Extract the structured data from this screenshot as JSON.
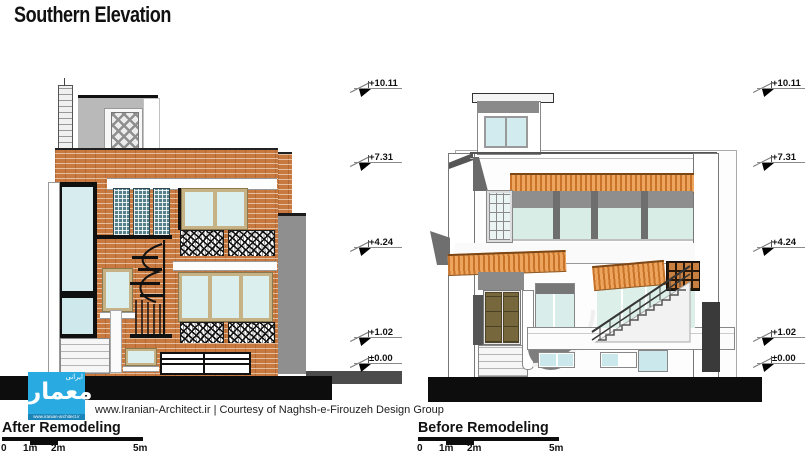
{
  "title": "Southern Elevation",
  "credit": "www.Iranian-Architect.ir | Courtesy of Naghsh-e-Firouzeh Design Group",
  "markers": {
    "values": [
      "+10.11",
      "+7.31",
      "+4.24",
      "+1.02",
      "±0.00"
    ]
  },
  "after": {
    "label": "After Remodeling",
    "ticks": [
      "0",
      "1m",
      "2m",
      "5m"
    ]
  },
  "before": {
    "label": "Before Remodeling",
    "ticks": [
      "0",
      "1m",
      "2m",
      "5m"
    ]
  },
  "logo": {
    "main": "معمار",
    "small": "ایرانی",
    "strip": "www.iranian-architect.ir"
  },
  "colors": {
    "brick": "#c8793f",
    "awning_orange": "#eda45c",
    "awning_stripe": "#c9732a",
    "glass": "#dcefef",
    "glass_green": "#d8ede6",
    "screen_teal": "#56808a",
    "frame_tan": "#c6b285",
    "door_olive": "#76683c",
    "logo_blue": "#29abe2",
    "ground_black": "#0d0d0d",
    "wall_gray": "#8f8f8f",
    "pillar_dark": "#3a3a3a"
  }
}
